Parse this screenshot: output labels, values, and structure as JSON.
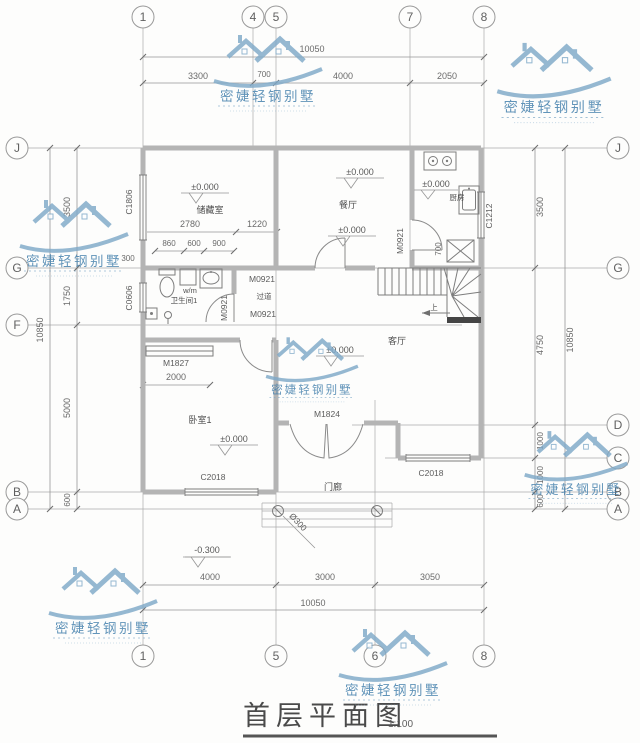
{
  "meta": {
    "title": "首层平面图",
    "scale": "1:100"
  },
  "watermark": {
    "text": "密婕轻钢别墅"
  },
  "grid": {
    "top": [
      "1",
      "4",
      "5",
      "7",
      "8"
    ],
    "bottom": [
      "1",
      "5",
      "6",
      "8"
    ],
    "left": [
      "J",
      "G",
      "F",
      "B",
      "A"
    ],
    "right": [
      "J",
      "G",
      "D",
      "C",
      "B",
      "A"
    ]
  },
  "dims": {
    "top_total": "10050",
    "top": [
      "3300",
      "700",
      "4000",
      "2050"
    ],
    "bottom": [
      "4000",
      "3000",
      "3050"
    ],
    "bottom_total": "10050",
    "left": [
      "3500",
      "1750",
      "5000",
      "600"
    ],
    "left_total": "10850",
    "right": [
      "3500",
      "4750",
      "1000",
      "1000",
      "600"
    ],
    "right_total": "10850",
    "storage": [
      "2780",
      "1220"
    ],
    "bath_chain": [
      "860",
      "600",
      "900"
    ],
    "offset": "300",
    "closet_width": "2000",
    "stair_width": "700"
  },
  "levels": {
    "zero": "±0.000",
    "minus": "-0.300"
  },
  "rooms": {
    "storage": "储藏室",
    "dining": "餐厅",
    "kitchen": "厨房",
    "bathroom": "卫生间1",
    "hallway": "过道",
    "living": "客厅",
    "bedroom": "卧室1",
    "porch": "门廊",
    "washer": "w/m",
    "up": "上"
  },
  "openings": {
    "c1806": "C1806",
    "c0606": "C0606",
    "c1212": "C1212",
    "c2018": "C2018",
    "m0921": "M0921",
    "m1827": "M1827",
    "m1824": "M1824",
    "column": "Ø300"
  }
}
